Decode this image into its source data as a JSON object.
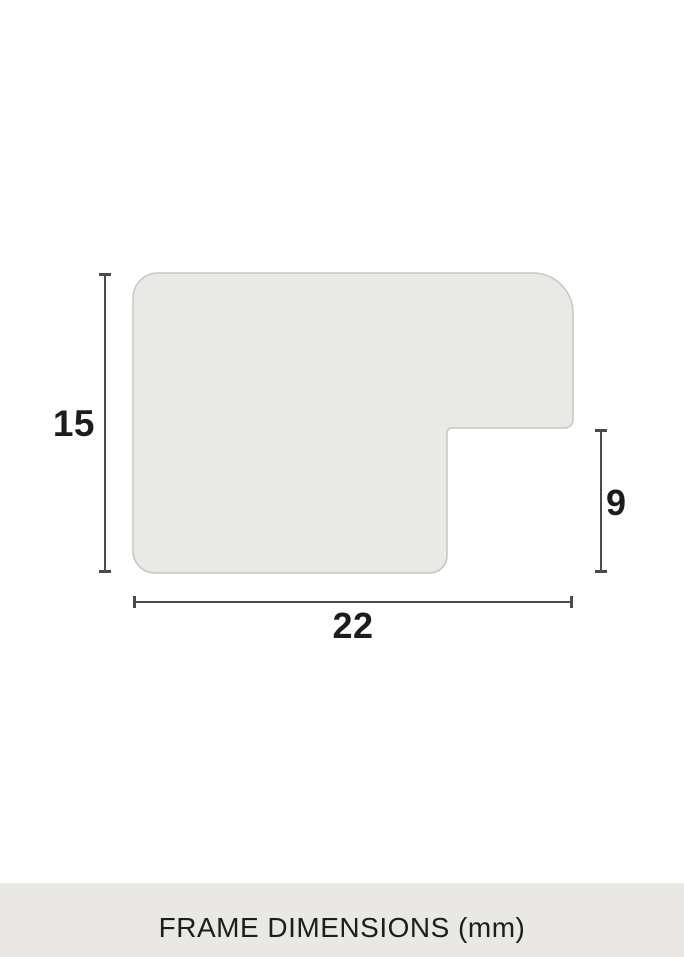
{
  "page": {
    "background_color": "#ffffff"
  },
  "diagram": {
    "type": "frame-profile-cross-section",
    "shape_fill_color": "#e9e9e5",
    "shape_stroke_color": "#c6c6c2",
    "dimension_line_color": "#4a4a4a",
    "unit": "mm",
    "dimensions": {
      "height": {
        "value": "15",
        "orientation": "vertical",
        "side": "left"
      },
      "width": {
        "value": "22",
        "orientation": "horizontal",
        "side": "bottom"
      },
      "rabbet": {
        "value": "9",
        "orientation": "vertical",
        "side": "right"
      }
    }
  },
  "caption": {
    "text": "FRAME DIMENSIONS (mm)",
    "background_color": "#e9e8e4",
    "text_color": "#1d1d1b"
  }
}
